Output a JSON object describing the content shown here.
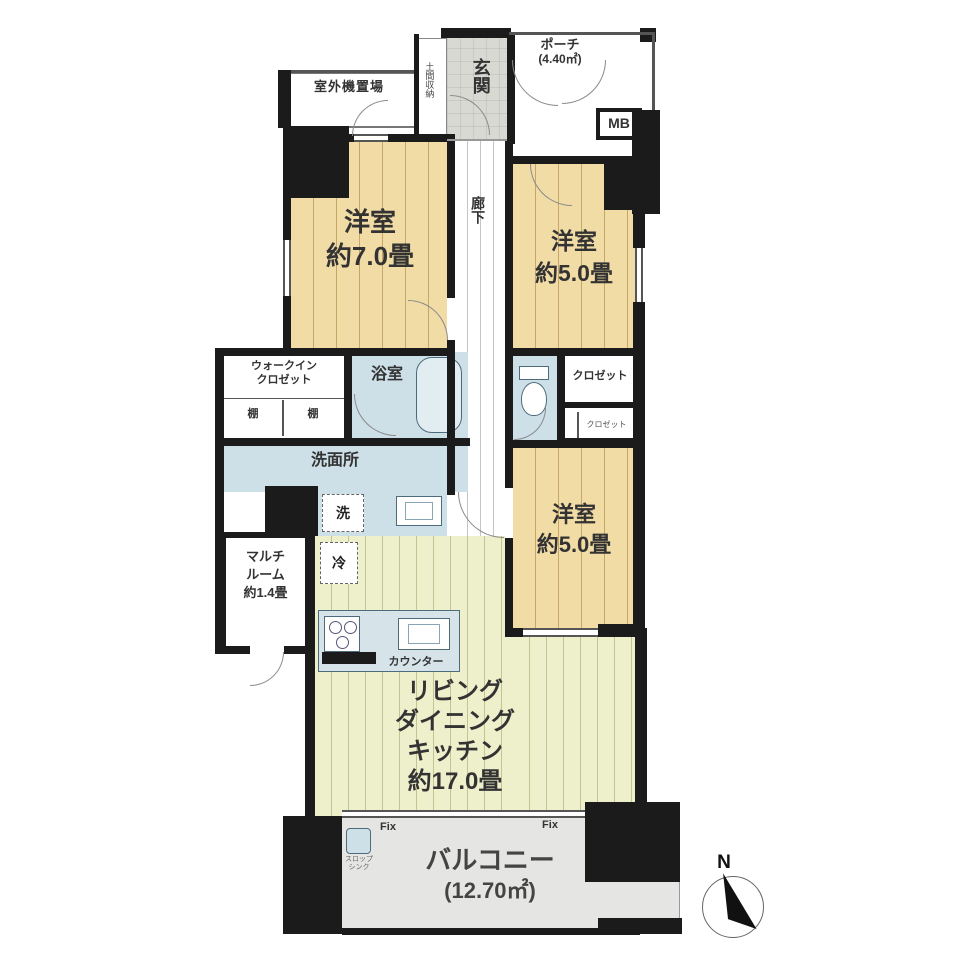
{
  "rooms": {
    "outdoor_unit": {
      "label": "室外機置場"
    },
    "porch": {
      "label": "ポーチ",
      "area": "(4.40㎡)"
    },
    "entrance": {
      "label": "玄関"
    },
    "doma_storage": {
      "label": "土間収納"
    },
    "meter_box": {
      "label": "MB"
    },
    "corridor": {
      "label": "廊下"
    },
    "bedroom_70": {
      "label": "洋室",
      "size": "約7.0畳"
    },
    "bedroom_50_upper": {
      "label": "洋室",
      "size": "約5.0畳"
    },
    "bedroom_50_lower": {
      "label": "洋室",
      "size": "約5.0畳"
    },
    "bathroom": {
      "label": "浴室"
    },
    "walk_in_closet": {
      "label_line1": "ウォークイン",
      "label_line2": "クロゼット",
      "shelf_left": "棚",
      "shelf_right": "棚"
    },
    "closet_upper": {
      "label": "クロゼット"
    },
    "closet_lower": {
      "label": "クロゼット"
    },
    "washroom": {
      "label": "洗面所",
      "washer_mark": "洗",
      "fridge_mark": "冷"
    },
    "multi_room": {
      "label_line1": "マルチ",
      "label_line2": "ルーム",
      "size": "約1.4畳"
    },
    "kitchen": {
      "counter_label": "カウンター"
    },
    "ldk": {
      "label_line1": "リビング",
      "label_line2": "ダイニング",
      "label_line3": "キッチン",
      "size": "約17.0畳"
    },
    "balcony": {
      "label": "バルコニー",
      "area": "(12.70㎡)",
      "fix_left": "Fix",
      "fix_right": "Fix",
      "slop_sink_line1": "スロップ",
      "slop_sink_line2": "シンク"
    }
  },
  "compass": {
    "north_label": "N"
  },
  "colors": {
    "wall": "#1b1b1b",
    "tatami_floor": "#f2dca6",
    "ldk_floor": "#eef0cb",
    "wet_area": "#cde0e8",
    "entrance_floor": "#d9d9d4",
    "balcony_floor": "#e5e5e3"
  }
}
